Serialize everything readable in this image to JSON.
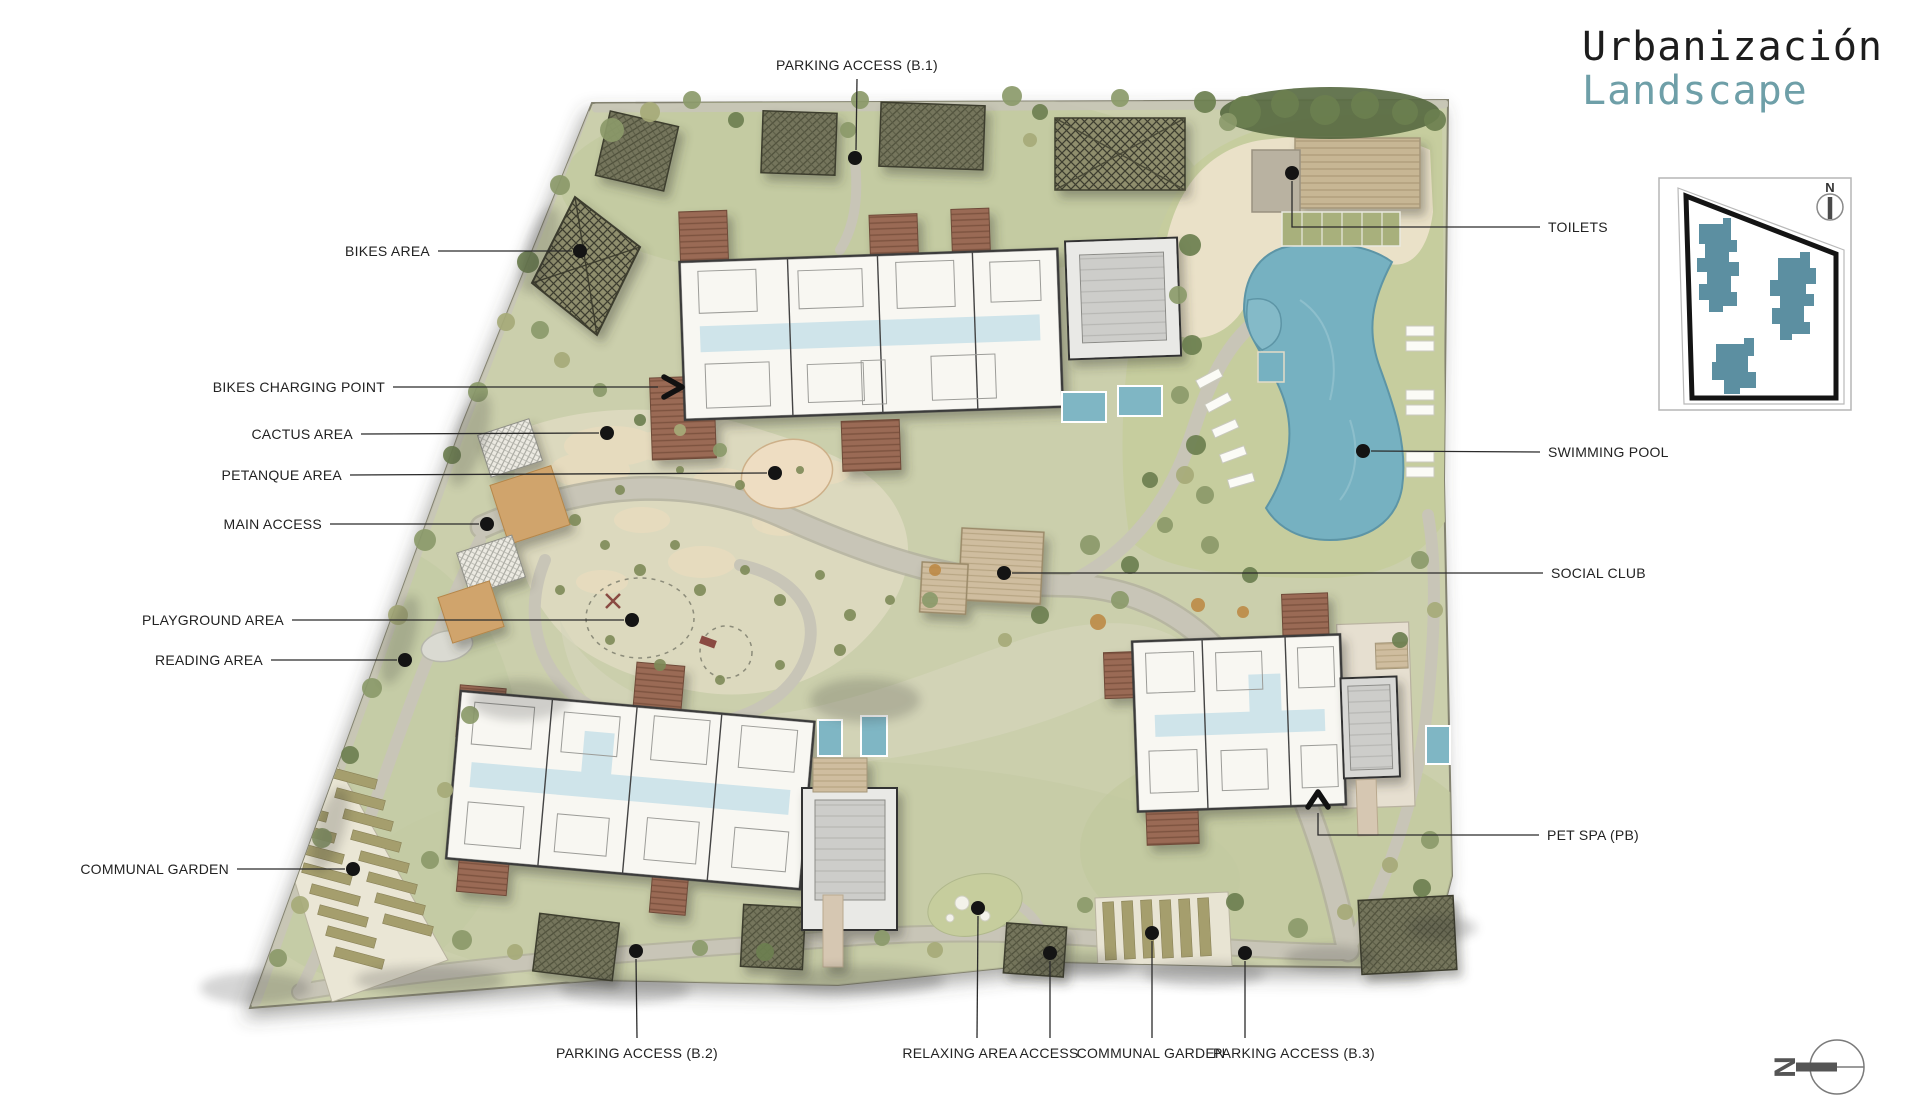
{
  "title": {
    "line1": "Urbanización",
    "line2": "Landscape"
  },
  "labels": {
    "parking_b1": "PARKING ACCESS (B.1)",
    "bikes_area": "BIKES AREA",
    "bikes_charging": "BIKES CHARGING POINT",
    "cactus": "CACTUS AREA",
    "petanque": "PETANQUE AREA",
    "main_access": "MAIN ACCESS",
    "playground": "PLAYGROUND AREA",
    "reading": "READING AREA",
    "communal_garden_left": "COMMUNAL GARDEN",
    "toilets": "TOILETS",
    "swimming_pool": "SWIMMING POOL",
    "social_club": "SOCIAL CLUB",
    "pet_spa": "PET SPA (PB)",
    "parking_b2": "PARKING ACCESS (B.2)",
    "relaxing": "RELAXING AREA",
    "access": "ACCESS",
    "communal_garden_bottom": "COMMUNAL GARDEN",
    "parking_b3": "PARKING ACCESS (B.3)"
  },
  "inset_map": {
    "north_label": "N"
  },
  "compass": {
    "north_label": "N"
  },
  "colors": {
    "accent_teal": "#6e9fa8",
    "pool": "#76b1c1",
    "inset_building": "#5c8fa1",
    "lawn": "#cbcfac"
  }
}
